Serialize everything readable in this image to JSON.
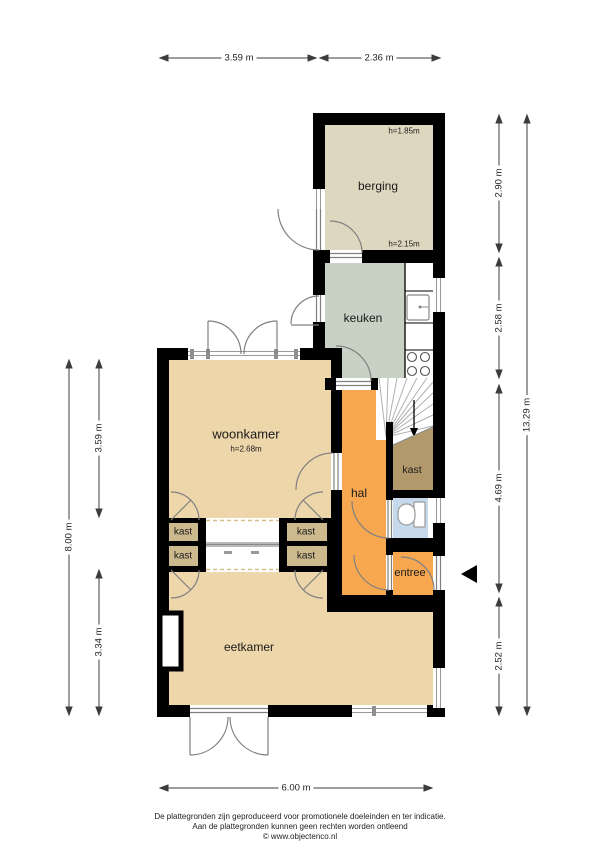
{
  "title": {
    "line1": "Van Hasseltstraat 36 - Kampen",
    "line2": "Begane Grond"
  },
  "rooms": {
    "berging": {
      "label": "berging",
      "h_top": "h=1.85m",
      "h_bottom": "h=2.15m"
    },
    "keuken": {
      "label": "keuken"
    },
    "woonkamer": {
      "label": "woonkamer",
      "h": "h=2.68m"
    },
    "hal": {
      "label": "hal"
    },
    "entree": {
      "label": "entree"
    },
    "eetkamer": {
      "label": "eetkamer"
    },
    "kast_under_stairs": {
      "label": "kast"
    },
    "closets": [
      "kast",
      "kast",
      "kast",
      "kast"
    ]
  },
  "dimensions": {
    "top": [
      "3.59 m",
      "2.36 m"
    ],
    "left_outer": "8.00 m",
    "left_inner": [
      "3.59 m",
      "3.34 m"
    ],
    "right_inner": [
      "2.90 m",
      "2.58 m",
      "4.69 m",
      "2.52 m"
    ],
    "right_outer": "13.29 m",
    "bottom": "6.00 m"
  },
  "footer": {
    "line1": "De plattegronden zijn geproduceerd voor promotionele doeleinden en ter indicatie.",
    "line2": "Aan de plattegronden kunnen geen rechten worden ontleend",
    "line3": "© www.objectenco.nl"
  },
  "colors": {
    "wall": "#000000",
    "berging_floor": "#ded7bf",
    "keuken_floor": "#c7d1c4",
    "living_floor": "#eed6ab",
    "hal_floor": "#f7a750",
    "closet_floor": "#cdb98e",
    "under_stairs_closet": "#b2996c",
    "toilet_floor": "#c6d9ec",
    "dimension_line": "#3c3c3c"
  }
}
